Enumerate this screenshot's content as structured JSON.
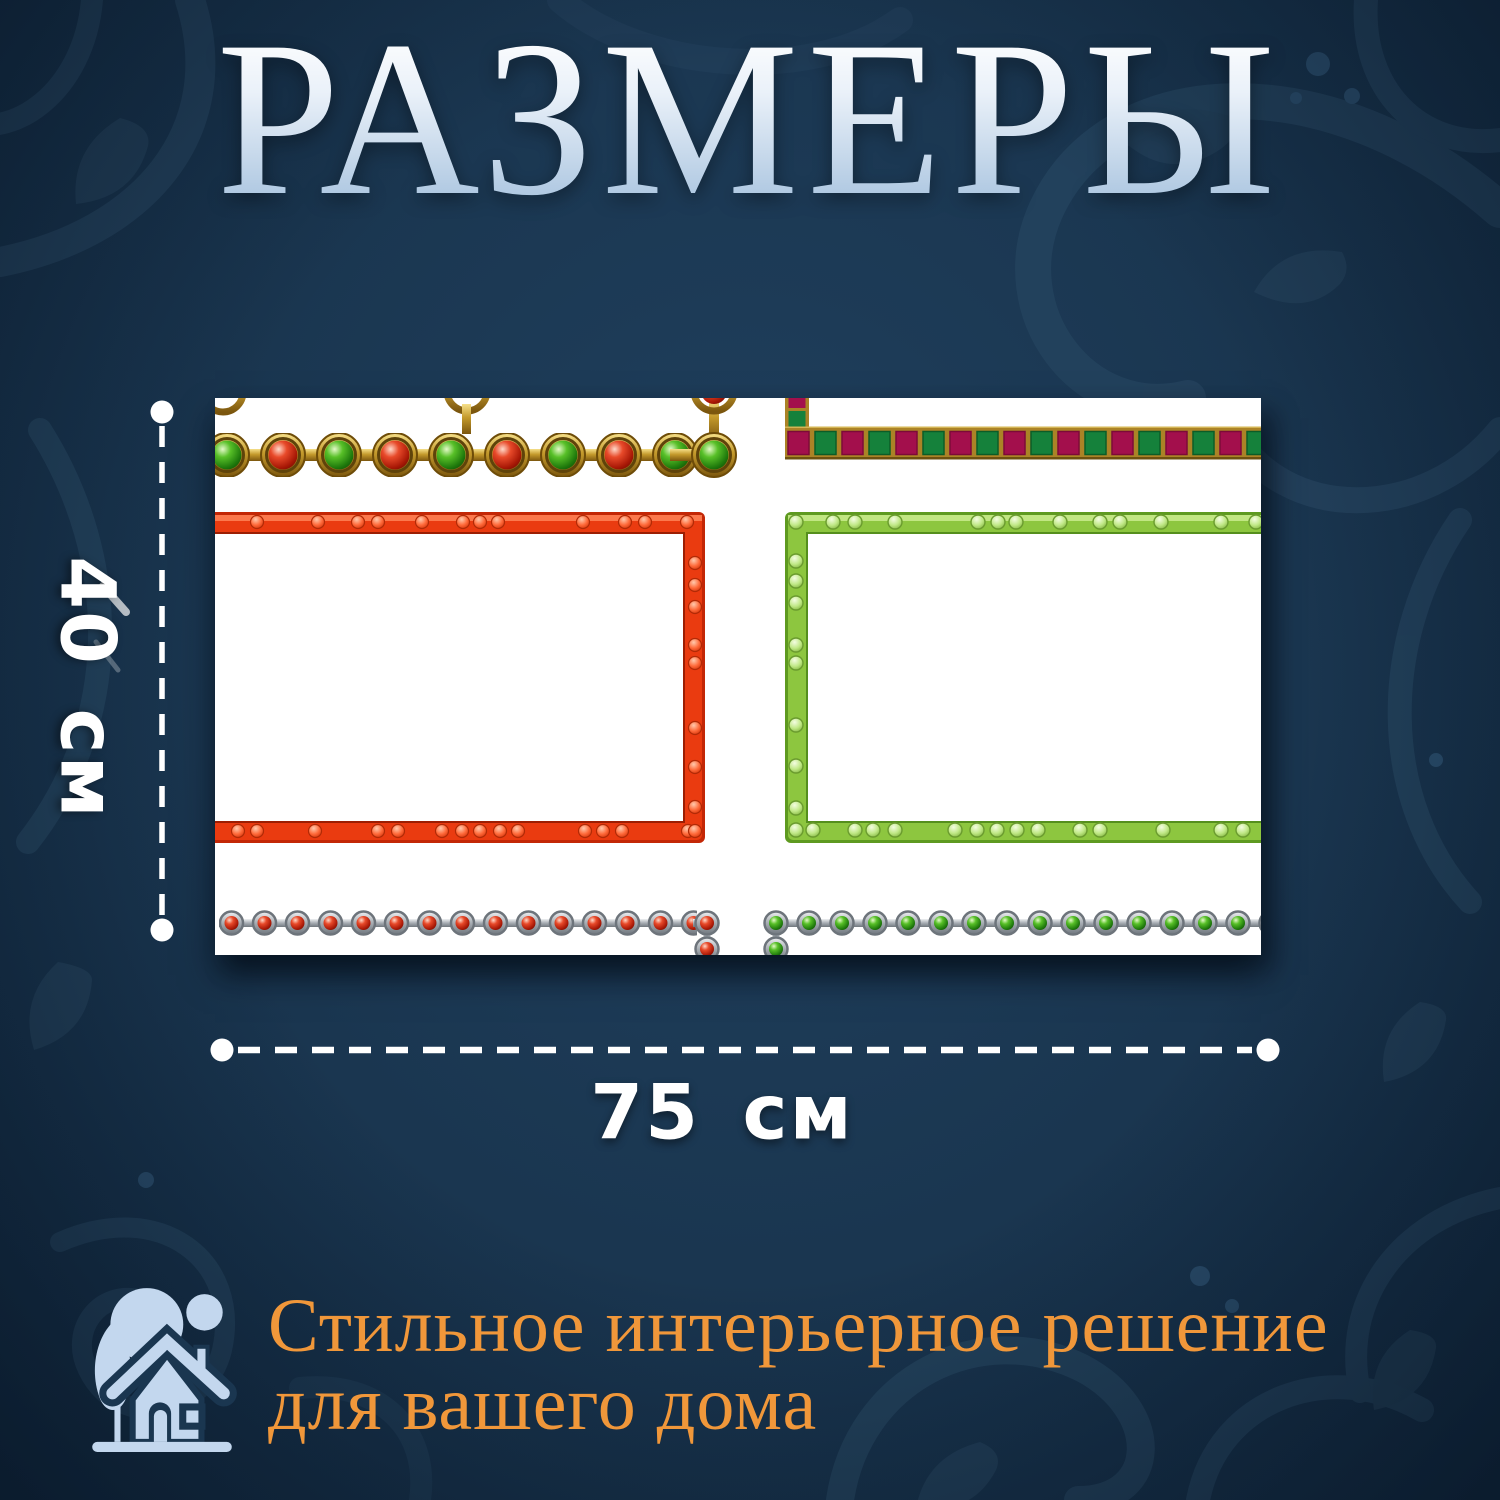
{
  "page": {
    "title": "РАЗМЕРЫ"
  },
  "theme": {
    "background_color": "#1a3650",
    "title_gradient_top": "#ffffff",
    "title_gradient_bottom": "#a6c2de",
    "dimension_color": "#ffffff",
    "accent_orange": "#f0973a",
    "icon_blue": "#c3d7ee"
  },
  "dimensions": {
    "height_label": "40 см",
    "width_label": "75 см"
  },
  "product_image": {
    "frame_red_color": "#ea3b10",
    "frame_green_color": "#8dc63f",
    "bead_red_color": "#d23218",
    "bead_green_color": "#4fb32a",
    "gold_color": "#c49a2c",
    "silver_color": "#a7adb3",
    "ribbon_crimson_color": "#a30f4c",
    "ribbon_green_color": "#15813b"
  },
  "footer": {
    "icon": "house-icon",
    "line1": "Стильное интерьерное решение",
    "line2": "для вашего дома"
  }
}
